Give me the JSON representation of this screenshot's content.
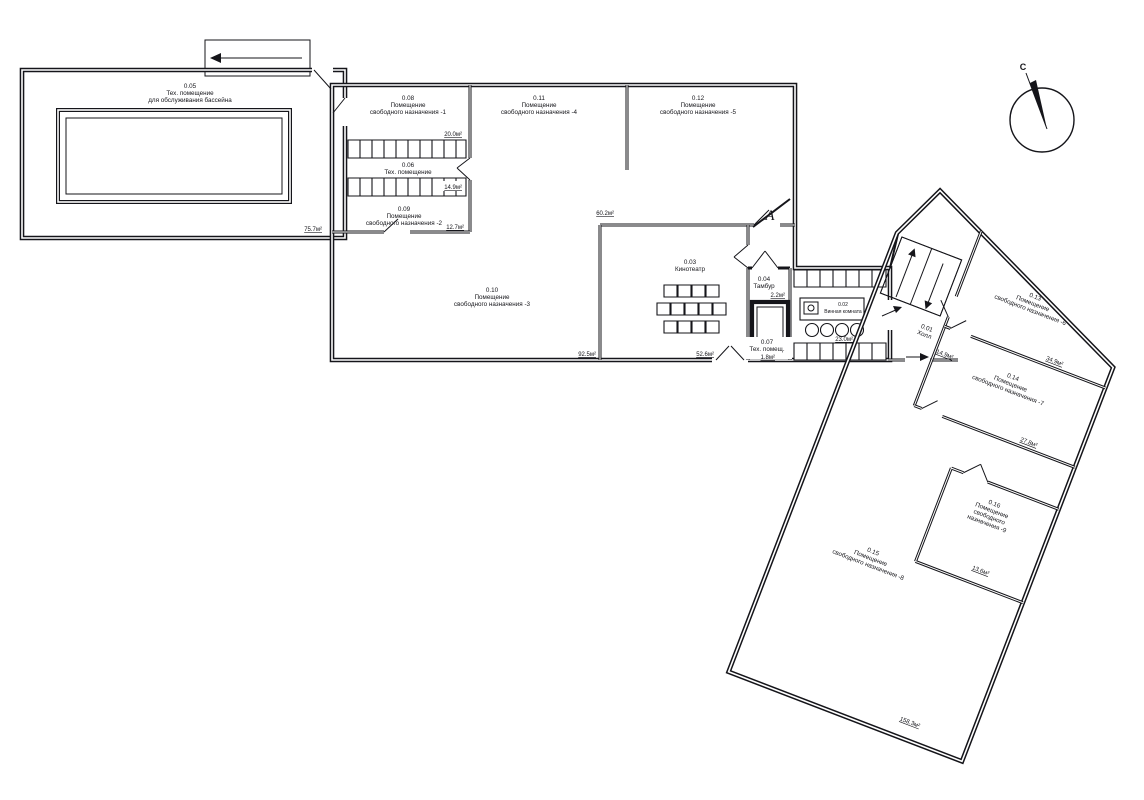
{
  "drawing": {
    "type": "basement-floor-plan",
    "compass": {
      "north_label": "С"
    },
    "section_marker": {
      "label": "А"
    }
  },
  "rooms": {
    "r01": {
      "id": "0.01",
      "name_lines": [
        "Холл"
      ],
      "area": "14.9м²"
    },
    "r02": {
      "id": "0.02",
      "name_lines": [
        "Винная комната"
      ],
      "area": "23.0м²"
    },
    "r03": {
      "id": "0.03",
      "name_lines": [
        "Кинотеатр"
      ],
      "area": "52.6м²"
    },
    "r04": {
      "id": "0.04",
      "name_lines": [
        "Тамбур"
      ],
      "area": "2.2м²"
    },
    "r05": {
      "id": "0.05",
      "name_lines": [
        "Тех. помещение",
        "для обслуживания бассейна"
      ],
      "area": "75.7м²"
    },
    "r06": {
      "id": "0.06",
      "name_lines": [
        "Тех. помещение"
      ],
      "area": "14.9м²"
    },
    "r07": {
      "id": "0.07",
      "name_lines": [
        "Тех. помещ."
      ],
      "area": "1.8м²"
    },
    "r08": {
      "id": "0.08",
      "name_lines": [
        "Помещение",
        "свободного назначения -1"
      ],
      "area": "20.0м²"
    },
    "r09": {
      "id": "0.09",
      "name_lines": [
        "Помещение",
        "свободного назначения -2"
      ],
      "area": "12.7м²"
    },
    "r10": {
      "id": "0.10",
      "name_lines": [
        "Помещение",
        "свободного назначения -3"
      ],
      "area": "92.5м²"
    },
    "r11": {
      "id": "0.11",
      "name_lines": [
        "Помещение",
        "свободного назначения -4"
      ],
      "area": "60.2м²"
    },
    "r12": {
      "id": "0.12",
      "name_lines": [
        "Помещение",
        "свободного назначения -5"
      ]
    },
    "r13": {
      "id": "0.13",
      "name_lines": [
        "Помещение",
        "свободного назначения -6"
      ],
      "area": "34.9м²"
    },
    "r14": {
      "id": "0.14",
      "name_lines": [
        "Помещение",
        "свободного назначения -7"
      ],
      "area": "27.8м²"
    },
    "r15": {
      "id": "0.15",
      "name_lines": [
        "Помещение",
        "свободного назначения -8"
      ],
      "area": "158.3м²"
    },
    "r16": {
      "id": "0.16",
      "name_lines": [
        "Помещение",
        "свободного",
        "назначения -9"
      ],
      "area": "13.6м²"
    }
  },
  "colors": {
    "line": "#15151a",
    "background": "#ffffff"
  }
}
